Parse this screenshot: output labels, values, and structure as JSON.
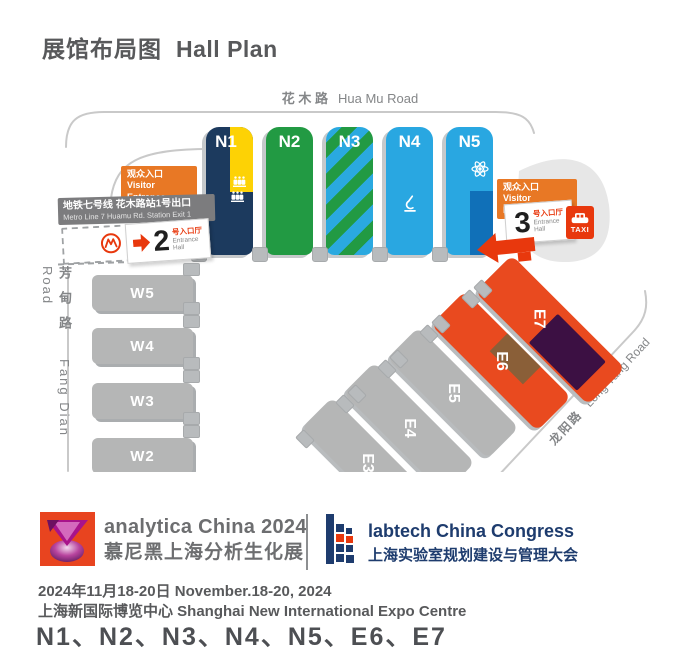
{
  "title": {
    "zh": "展馆布局图",
    "en": "Hall Plan"
  },
  "roads": {
    "huamu": {
      "zh": "花 木 路",
      "en": "Hua Mu Road"
    },
    "fangdian": {
      "zh": "芳甸路",
      "en": "Fang Dian Road"
    },
    "longyang": {
      "zh": "龙阳路",
      "en": "Long Yang Road"
    }
  },
  "west_entrance": {
    "visitor": {
      "zh": "观众入口",
      "en": "Visitor Entrance"
    },
    "metro": {
      "zh": "地铁七号线 花木路站1号出口",
      "en": "Metro Line 7  Huamu Rd. Station Exit 1"
    },
    "hall_no": "2",
    "hall_suffix": {
      "zh": "号入口厅",
      "en1": "Entrance",
      "en2": "Hall"
    }
  },
  "east_entrance": {
    "visitor": {
      "zh": "观众入口",
      "en": "Visitor Entrance"
    },
    "hall_no": "3",
    "hall_suffix": {
      "zh": "号入口厅",
      "en1": "Entrance",
      "en2": "Hall"
    },
    "taxi_label": "TAXI"
  },
  "halls": {
    "north": [
      {
        "label": "N1",
        "color": "#1c3a5e",
        "accent": "#fdd205"
      },
      {
        "label": "N2",
        "color": "#229a43"
      },
      {
        "label": "N3",
        "color": "#2aa9e0",
        "stripe": "#229a43"
      },
      {
        "label": "N4",
        "color": "#29a7e1"
      },
      {
        "label": "N5",
        "color": "#29a7e1",
        "accent": "#1070b8"
      }
    ],
    "west": [
      {
        "label": "W5"
      },
      {
        "label": "W4"
      },
      {
        "label": "W3"
      },
      {
        "label": "W2"
      }
    ],
    "east": [
      {
        "label": "E7",
        "color": "#e94a1f",
        "accent": "#3c1043"
      },
      {
        "label": "E6",
        "color": "#e94a1f",
        "accent": "#8a5f38"
      },
      {
        "label": "E5",
        "color": "#b5b6b6"
      },
      {
        "label": "E4",
        "color": "#b5b6b6"
      },
      {
        "label": "E3",
        "color": "#b5b6b6"
      }
    ]
  },
  "footer": {
    "analytica": {
      "name": "analytica China 2024",
      "zh": "慕尼黑上海分析生化展"
    },
    "labtech": {
      "name_a": "labtech China",
      "name_b": "Congress",
      "zh": "上海实验室规划建设与管理大会"
    },
    "date": "2024年11月18-20日  November.18-20, 2024",
    "venue": "上海新国际博览中心 Shanghai New International Expo Centre",
    "halls": "N1、N2、N3、N4、N5、E6、E7"
  },
  "colors": {
    "navy": "#1c3a5e",
    "yellow": "#fdd205",
    "green": "#229a43",
    "light_blue": "#29a7e1",
    "dark_blue": "#1070b8",
    "orange_hall": "#e94a1f",
    "purple": "#3c1043",
    "brown": "#8a5f38",
    "gray_hall": "#b5b6b6",
    "entrance_orange": "#e87825",
    "metro_gray": "#7c7c7e",
    "accent_red": "#e8380d",
    "logo_gray": "#6d6e70",
    "logo_blue": "#1e3c6e",
    "text_gray": "#58595b"
  }
}
